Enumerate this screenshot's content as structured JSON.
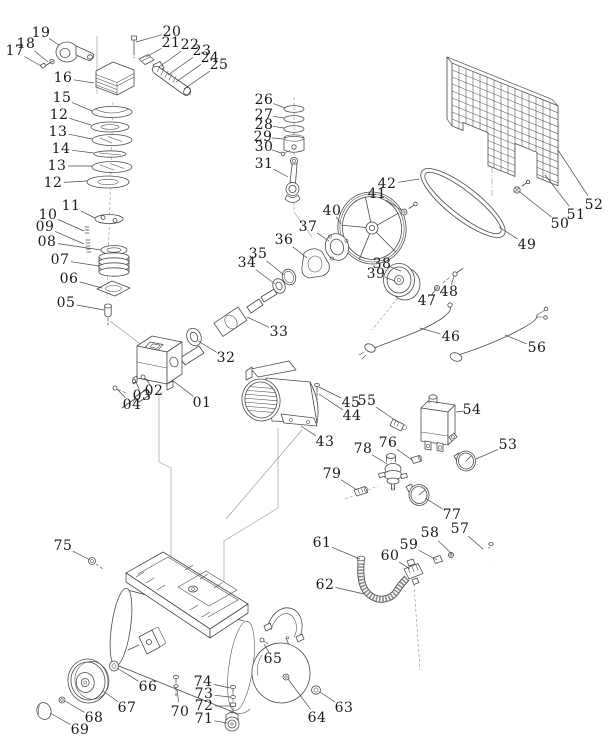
{
  "window": {
    "width": 615,
    "height": 755,
    "background": "#ffffff"
  },
  "diagram": {
    "type": "exploded-parts-diagram",
    "subject": "air compressor assembly",
    "line_color": "#4a4a4a",
    "label_color": "#1a1a1a",
    "label_font_size": 14,
    "leader_width": 0.7,
    "parts": [
      {
        "label": "01",
        "x": 202,
        "y": 403,
        "tx": 172,
        "ty": 380
      },
      {
        "label": "02",
        "x": 154,
        "y": 391,
        "tx": 146,
        "ty": 379
      },
      {
        "label": "03",
        "x": 142,
        "y": 396,
        "tx": 136,
        "ty": 382
      },
      {
        "label": "04",
        "x": 132,
        "y": 405,
        "tx": 117,
        "ty": 389
      },
      {
        "label": "05",
        "x": 66,
        "y": 303,
        "tx": 104,
        "ty": 310
      },
      {
        "label": "06",
        "x": 69,
        "y": 279,
        "tx": 102,
        "ty": 288
      },
      {
        "label": "07",
        "x": 60,
        "y": 260,
        "tx": 99,
        "ty": 266
      },
      {
        "label": "08",
        "x": 47,
        "y": 242,
        "tx": 101,
        "ty": 250
      },
      {
        "label": "09",
        "x": 45,
        "y": 227,
        "tx": 84,
        "ty": 244
      },
      {
        "label": "10",
        "x": 48,
        "y": 215,
        "tx": 84,
        "ty": 231
      },
      {
        "label": "11",
        "x": 71,
        "y": 206,
        "tx": 95,
        "ty": 218
      },
      {
        "label": "12",
        "x": 59,
        "y": 115,
        "tx": 91,
        "ty": 125
      },
      {
        "label": "13",
        "x": 58,
        "y": 132,
        "tx": 92,
        "ty": 139
      },
      {
        "label": "14",
        "x": 61,
        "y": 149,
        "tx": 94,
        "ty": 153
      },
      {
        "label": "13",
        "x": 57,
        "y": 166,
        "tx": 92,
        "ty": 166
      },
      {
        "label": "12",
        "x": 53,
        "y": 183,
        "tx": 87,
        "ty": 181
      },
      {
        "label": "15",
        "x": 62,
        "y": 98,
        "tx": 92,
        "ty": 111
      },
      {
        "label": "16",
        "x": 63,
        "y": 78,
        "tx": 94,
        "ty": 83
      },
      {
        "label": "17",
        "x": 15,
        "y": 51,
        "tx": 41,
        "ty": 66
      },
      {
        "label": "18",
        "x": 26,
        "y": 44,
        "tx": 48,
        "ty": 62
      },
      {
        "label": "19",
        "x": 41,
        "y": 33,
        "tx": 59,
        "ty": 45
      },
      {
        "label": "20",
        "x": 172,
        "y": 32,
        "tx": 136,
        "ty": 42
      },
      {
        "label": "21",
        "x": 171,
        "y": 43,
        "tx": 146,
        "ty": 57
      },
      {
        "label": "22",
        "x": 190,
        "y": 45,
        "tx": 159,
        "ty": 67
      },
      {
        "label": "23",
        "x": 202,
        "y": 51,
        "tx": 168,
        "ty": 75
      },
      {
        "label": "24",
        "x": 210,
        "y": 58,
        "tx": 176,
        "ty": 82
      },
      {
        "label": "25",
        "x": 219,
        "y": 65,
        "tx": 184,
        "ty": 89
      },
      {
        "label": "26",
        "x": 264,
        "y": 100,
        "tx": 285,
        "ty": 108
      },
      {
        "label": "27",
        "x": 264,
        "y": 115,
        "tx": 284,
        "ty": 118
      },
      {
        "label": "28",
        "x": 264,
        "y": 125,
        "tx": 284,
        "ty": 128
      },
      {
        "label": "29",
        "x": 263,
        "y": 137,
        "tx": 283,
        "ty": 139
      },
      {
        "label": "30",
        "x": 264,
        "y": 147,
        "tx": 281,
        "ty": 153
      },
      {
        "label": "31",
        "x": 264,
        "y": 164,
        "tx": 288,
        "ty": 177
      },
      {
        "label": "32",
        "x": 226,
        "y": 358,
        "tx": 198,
        "ty": 341
      },
      {
        "label": "33",
        "x": 279,
        "y": 332,
        "tx": 247,
        "ty": 317
      },
      {
        "label": "34",
        "x": 247,
        "y": 263,
        "tx": 275,
        "ty": 284
      },
      {
        "label": "35",
        "x": 258,
        "y": 254,
        "tx": 284,
        "ty": 275
      },
      {
        "label": "36",
        "x": 284,
        "y": 240,
        "tx": 307,
        "ty": 258
      },
      {
        "label": "37",
        "x": 308,
        "y": 227,
        "tx": 329,
        "ty": 241
      },
      {
        "label": "38",
        "x": 382,
        "y": 264,
        "tx": 401,
        "ty": 271
      },
      {
        "label": "39",
        "x": 376,
        "y": 274,
        "tx": 395,
        "ty": 281
      },
      {
        "label": "40",
        "x": 332,
        "y": 211,
        "tx": 341,
        "ty": 224
      },
      {
        "label": "41",
        "x": 377,
        "y": 194,
        "tx": 401,
        "ty": 210
      },
      {
        "label": "42",
        "x": 387,
        "y": 184,
        "tx": 419,
        "ty": 179
      },
      {
        "label": "43",
        "x": 325,
        "y": 442,
        "tx": 301,
        "ty": 426
      },
      {
        "label": "44",
        "x": 352,
        "y": 416,
        "tx": 319,
        "ty": 394
      },
      {
        "label": "45",
        "x": 351,
        "y": 403,
        "tx": 319,
        "ty": 387
      },
      {
        "label": "46",
        "x": 451,
        "y": 337,
        "tx": 420,
        "ty": 328
      },
      {
        "label": "47",
        "x": 427,
        "y": 301,
        "tx": 436,
        "ty": 289
      },
      {
        "label": "48",
        "x": 449,
        "y": 292,
        "tx": 454,
        "ty": 276
      },
      {
        "label": "49",
        "x": 527,
        "y": 245,
        "tx": 499,
        "ty": 227
      },
      {
        "label": "50",
        "x": 560,
        "y": 224,
        "tx": 520,
        "ty": 192
      },
      {
        "label": "51",
        "x": 576,
        "y": 215,
        "tx": 545,
        "ty": 175
      },
      {
        "label": "52",
        "x": 594,
        "y": 205,
        "tx": 558,
        "ty": 150
      },
      {
        "label": "53",
        "x": 508,
        "y": 445,
        "tx": 476,
        "ty": 459
      },
      {
        "label": "54",
        "x": 472,
        "y": 410,
        "tx": 456,
        "ty": 412
      },
      {
        "label": "55",
        "x": 367,
        "y": 401,
        "tx": 398,
        "ty": 422
      },
      {
        "label": "56",
        "x": 537,
        "y": 348,
        "tx": 505,
        "ty": 335
      },
      {
        "label": "57",
        "x": 460,
        "y": 529,
        "tx": 483,
        "ty": 549
      },
      {
        "label": "58",
        "x": 430,
        "y": 533,
        "tx": 452,
        "ty": 554
      },
      {
        "label": "59",
        "x": 409,
        "y": 545,
        "tx": 437,
        "ty": 560
      },
      {
        "label": "60",
        "x": 390,
        "y": 556,
        "tx": 410,
        "ty": 569
      },
      {
        "label": "61",
        "x": 322,
        "y": 543,
        "tx": 360,
        "ty": 559
      },
      {
        "label": "62",
        "x": 325,
        "y": 585,
        "tx": 364,
        "ty": 594
      },
      {
        "label": "63",
        "x": 344,
        "y": 708,
        "tx": 320,
        "ty": 692
      },
      {
        "label": "64",
        "x": 317,
        "y": 718,
        "tx": 288,
        "ty": 679
      },
      {
        "label": "65",
        "x": 273,
        "y": 659,
        "tx": 264,
        "ty": 644
      },
      {
        "label": "66",
        "x": 148,
        "y": 687,
        "tx": 117,
        "ty": 668
      },
      {
        "label": "67",
        "x": 127,
        "y": 708,
        "tx": 103,
        "ty": 691
      },
      {
        "label": "68",
        "x": 94,
        "y": 718,
        "tx": 65,
        "ty": 701
      },
      {
        "label": "69",
        "x": 80,
        "y": 730,
        "tx": 50,
        "ty": 713
      },
      {
        "label": "70",
        "x": 180,
        "y": 712,
        "tx": 177,
        "ty": 690
      },
      {
        "label": "71",
        "x": 204,
        "y": 719,
        "tx": 227,
        "ty": 723
      },
      {
        "label": "72",
        "x": 204,
        "y": 706,
        "tx": 230,
        "ty": 706
      },
      {
        "label": "73",
        "x": 204,
        "y": 694,
        "tx": 230,
        "ty": 697
      },
      {
        "label": "74",
        "x": 203,
        "y": 682,
        "tx": 230,
        "ty": 688
      },
      {
        "label": "75",
        "x": 63,
        "y": 546,
        "tx": 90,
        "ty": 560
      },
      {
        "label": "76",
        "x": 388,
        "y": 443,
        "tx": 412,
        "ty": 460
      },
      {
        "label": "77",
        "x": 452,
        "y": 515,
        "tx": 425,
        "ty": 498
      },
      {
        "label": "78",
        "x": 363,
        "y": 449,
        "tx": 387,
        "ty": 464
      },
      {
        "label": "79",
        "x": 332,
        "y": 474,
        "tx": 357,
        "ty": 490
      }
    ]
  }
}
